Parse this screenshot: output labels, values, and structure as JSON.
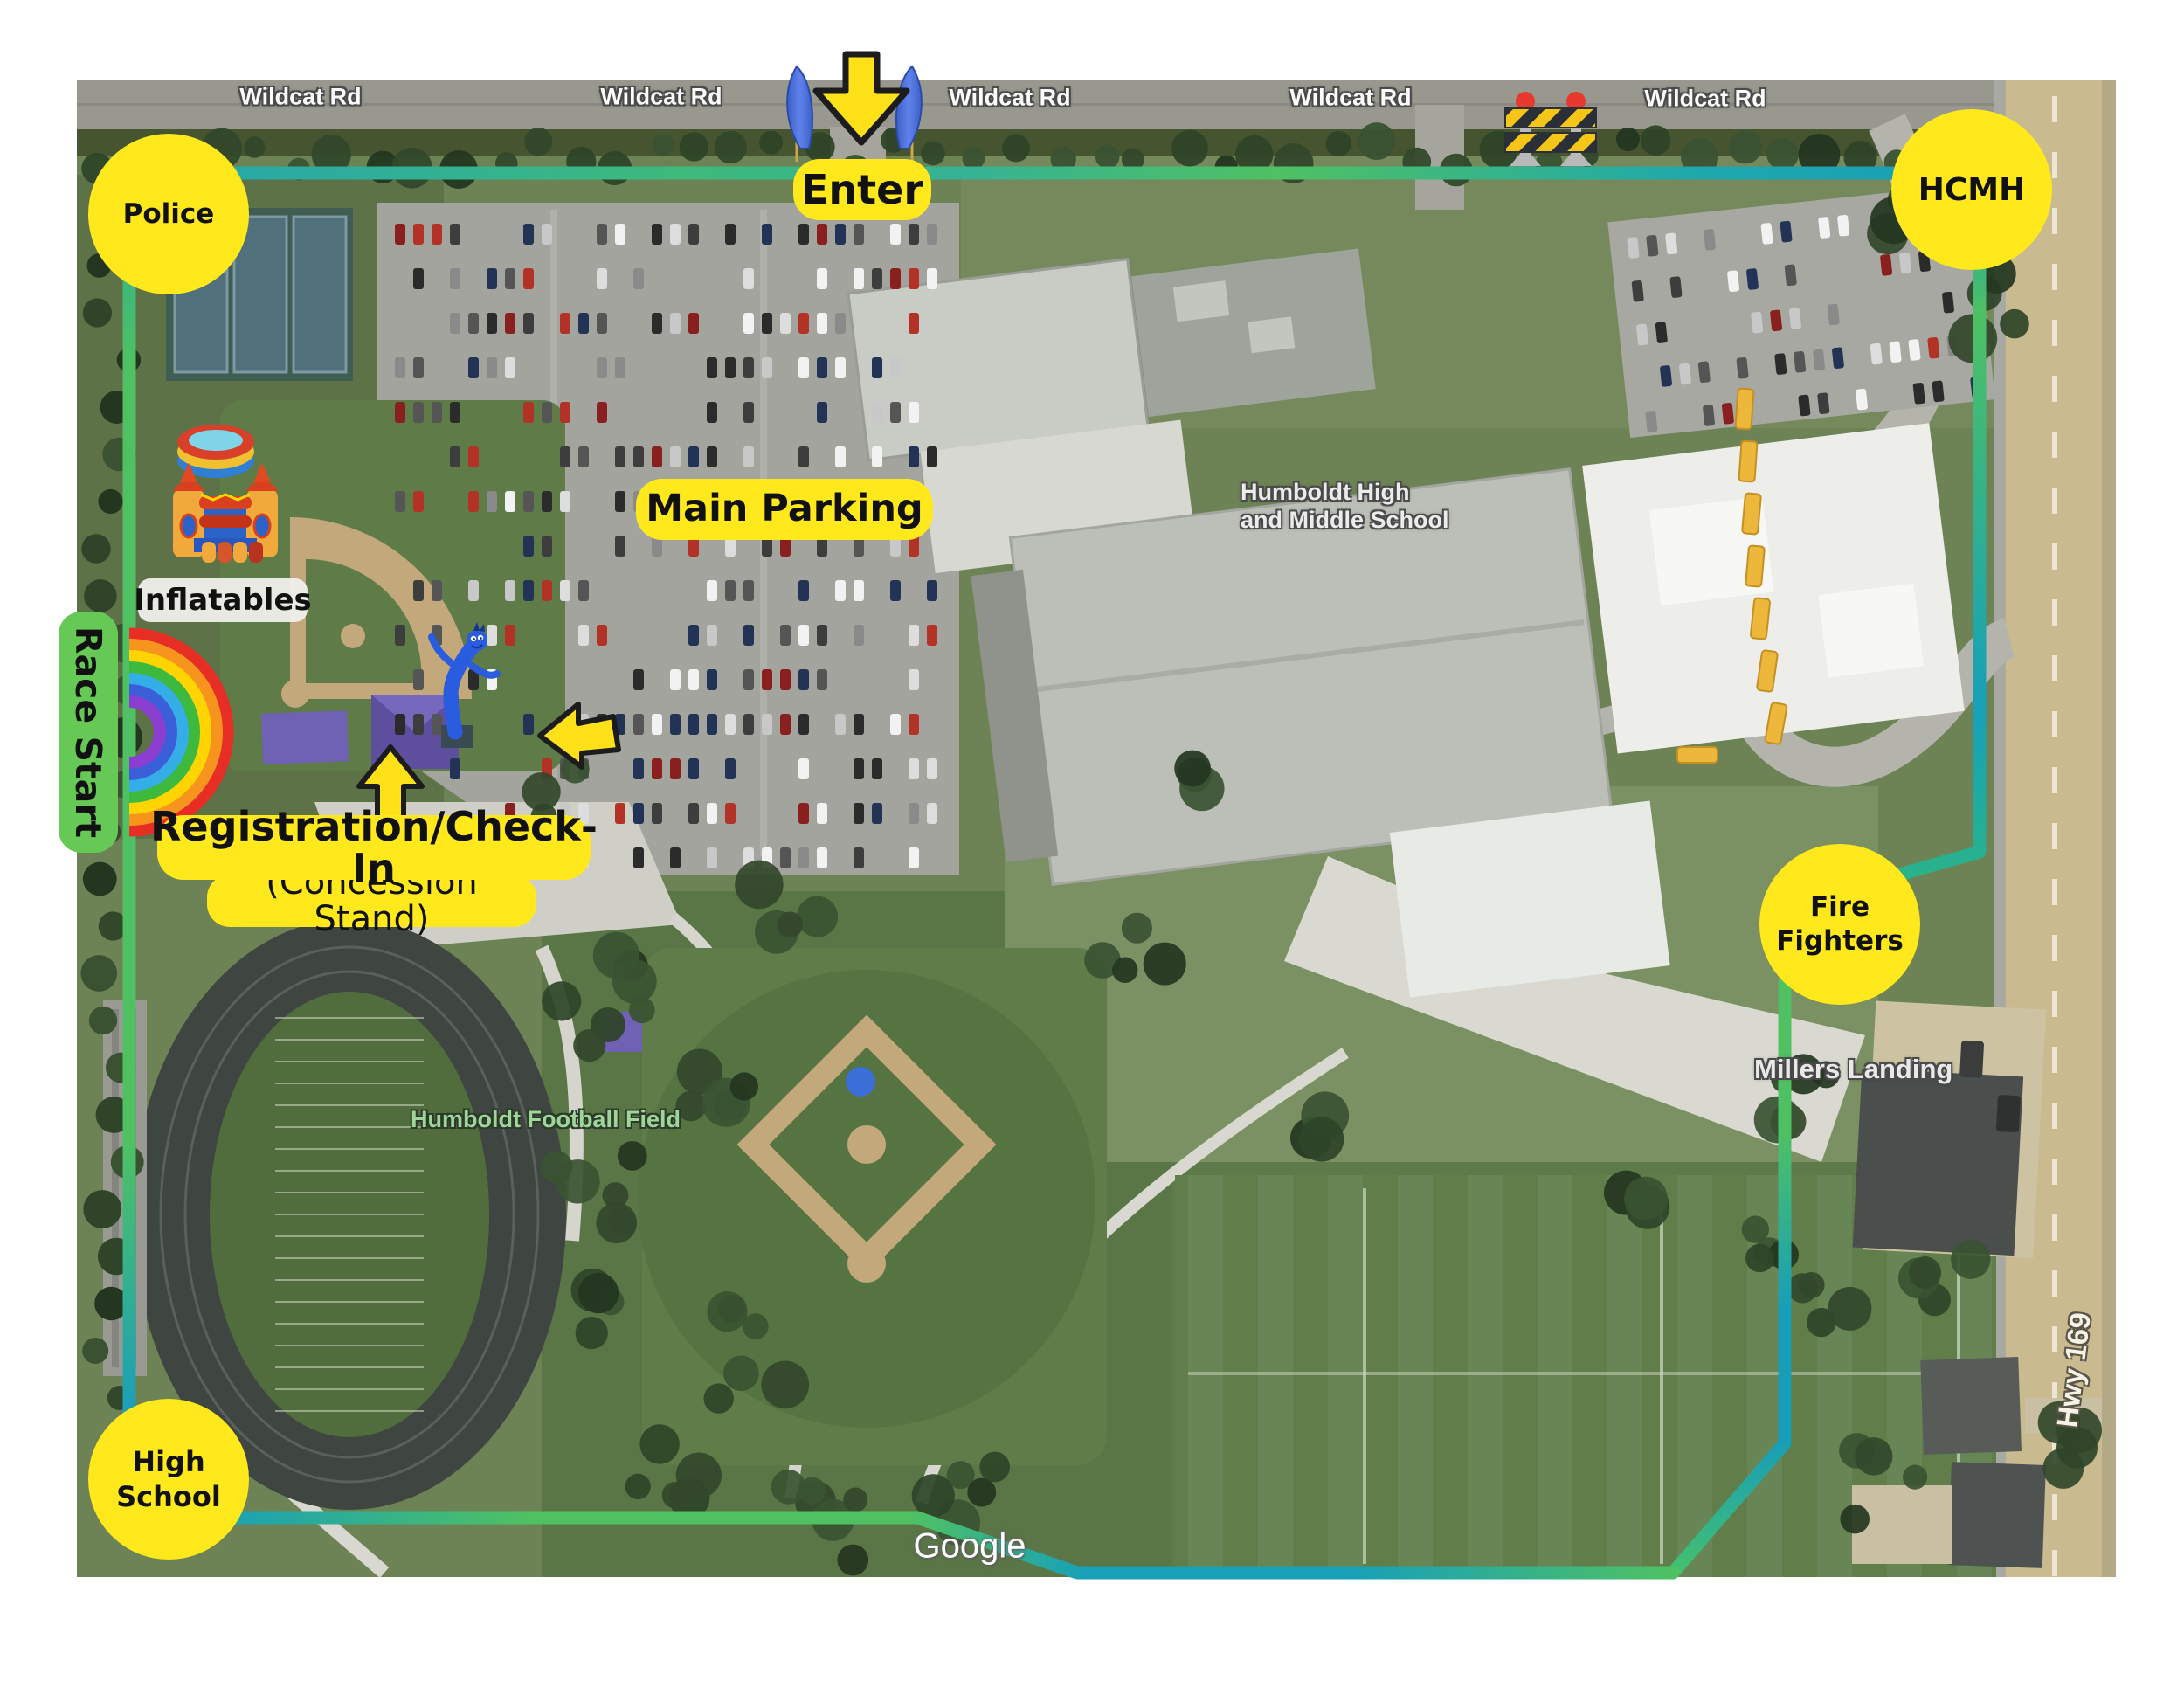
{
  "title": "Race event map - Humboldt High and Middle School",
  "colors": {
    "label_yellow": "#FFE81C",
    "race_start_green": "#67C955",
    "route_green": "#4FC163",
    "route_teal": "#189EB7"
  },
  "roads": {
    "wildcat": [
      "Wildcat Rd",
      "Wildcat Rd",
      "Wildcat Rd",
      "Wildcat Rd",
      "Wildcat Rd"
    ],
    "hwy": "Hwy 169"
  },
  "markers": {
    "police": "Police",
    "hcmh": "HCMH",
    "fire_line1": "Fire",
    "fire_line2": "Fighters",
    "hs_line1": "High",
    "hs_line2": "School"
  },
  "labels": {
    "enter": "Enter",
    "main_parking": "Main Parking",
    "inflatables": "Inflatables",
    "race_start": "Race Start",
    "registration_title": "Registration/Check-In",
    "registration_subtitle": "(Concession Stand)"
  },
  "map_text": {
    "school_line1": "Humboldt High",
    "school_line2": "and Middle School",
    "football_field": "Humboldt Football Field",
    "millers_landing": "Millers Landing"
  },
  "watermark": {
    "google": "Google"
  },
  "icons": [
    "enter-arrow-icon",
    "feather-flag-icon",
    "barricade-icon",
    "rainbow-icon",
    "bounce-house-icon",
    "pool-ring-icon",
    "tube-man-icon",
    "registration-arrow-icon",
    "drop-off-arrow-icon"
  ]
}
